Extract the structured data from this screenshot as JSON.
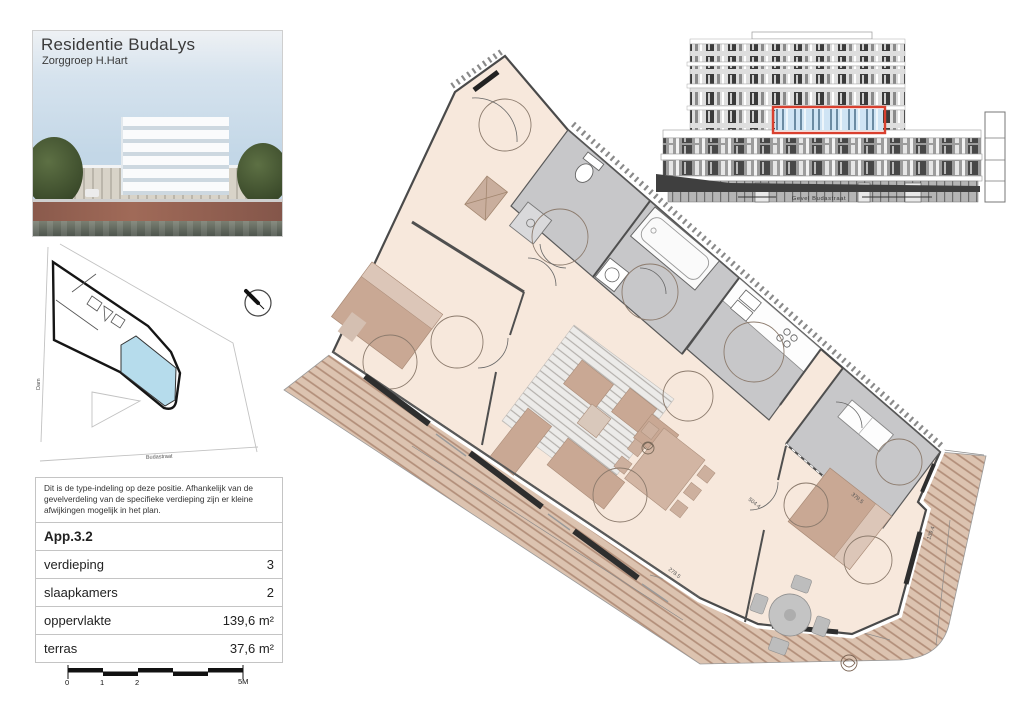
{
  "project": {
    "title": "Residentie BudaLys",
    "subtitle": "Zorggroep H.Hart"
  },
  "elevation": {
    "caption": "Gevel Budastraat"
  },
  "site_plan": {
    "street_label_left": "Dam",
    "street_label_bottom": "Budastraat"
  },
  "note": {
    "text": "Dit is de type-indeling op deze positie. Afhankelijk van de gevelverdeling van de specifieke verdieping zijn er kleine afwijkingen mogelijk in het plan."
  },
  "info_table": {
    "apartment_id": "App.3.2",
    "rows": [
      {
        "label": "verdieping",
        "value": "3"
      },
      {
        "label": "slaapkamers",
        "value": "2"
      },
      {
        "label": "oppervlakte",
        "value": "139,6 m²"
      },
      {
        "label": "terras",
        "value": "37,6 m²"
      }
    ]
  },
  "scale_bar": {
    "labels": [
      "0",
      "1",
      "2",
      "5M"
    ]
  },
  "floor_plan": {
    "dimension_labels": [
      "504.4",
      "379.5",
      "278.5",
      "139.4"
    ]
  },
  "colors": {
    "floor_cream": "#f7e8dc",
    "wet_room_gray": "#c7c7c9",
    "terrace_tan": "#dcc3b0",
    "terrace_stripe": "#b28e79",
    "furniture_tan": "#c9a894",
    "accent_red": "#d9402f",
    "highlight_blue": "#b6dcec",
    "wall": "#4a4a4a"
  }
}
